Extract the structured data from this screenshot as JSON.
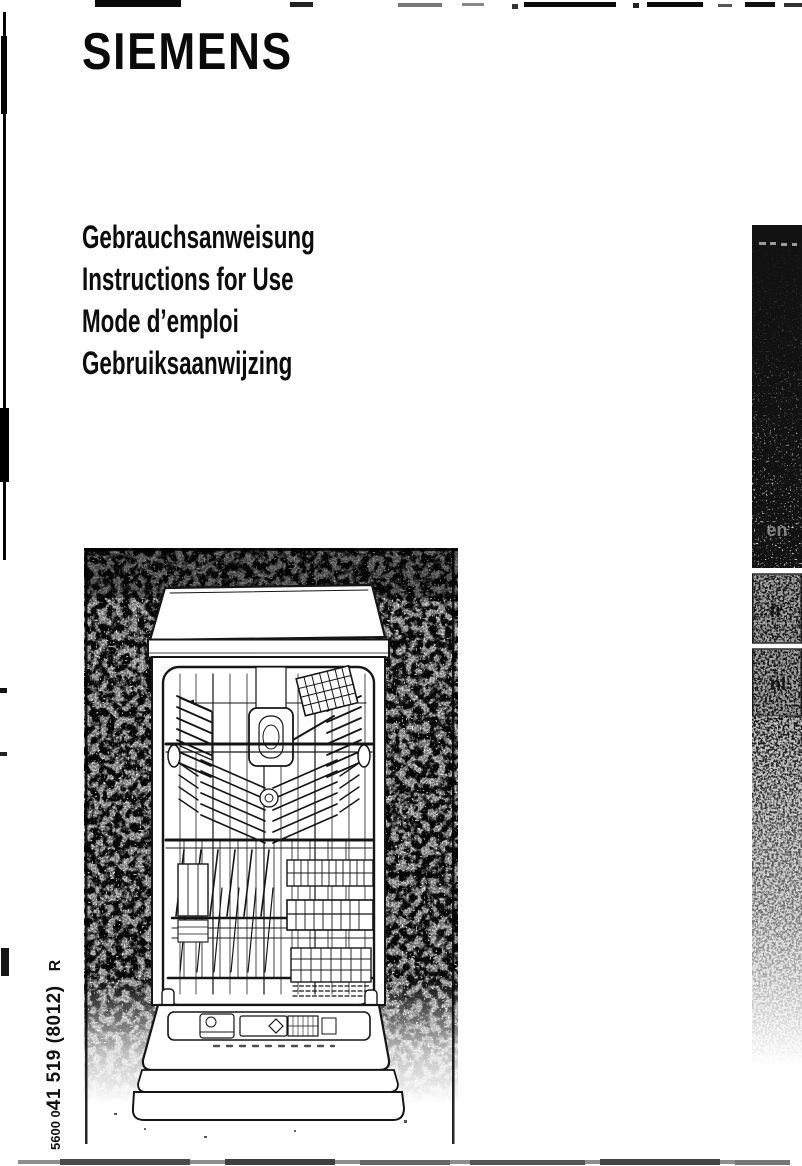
{
  "brand": "SIEMENS",
  "titles": [
    "Gebrauchsanweisung",
    "Instructions for Use",
    "Mode d’emploi",
    "Gebruiksaanwijzing"
  ],
  "language_tabs": [
    "en",
    "fr",
    "nl"
  ],
  "doc_number": {
    "prefix": "5600 0",
    "main": "41 519 (8012)",
    "suffix": "R"
  },
  "colors": {
    "ink": "#0d0d0d",
    "paper": "#ffffff",
    "tab_dark": "#121212",
    "tab_gray": "#a3a3a3"
  }
}
